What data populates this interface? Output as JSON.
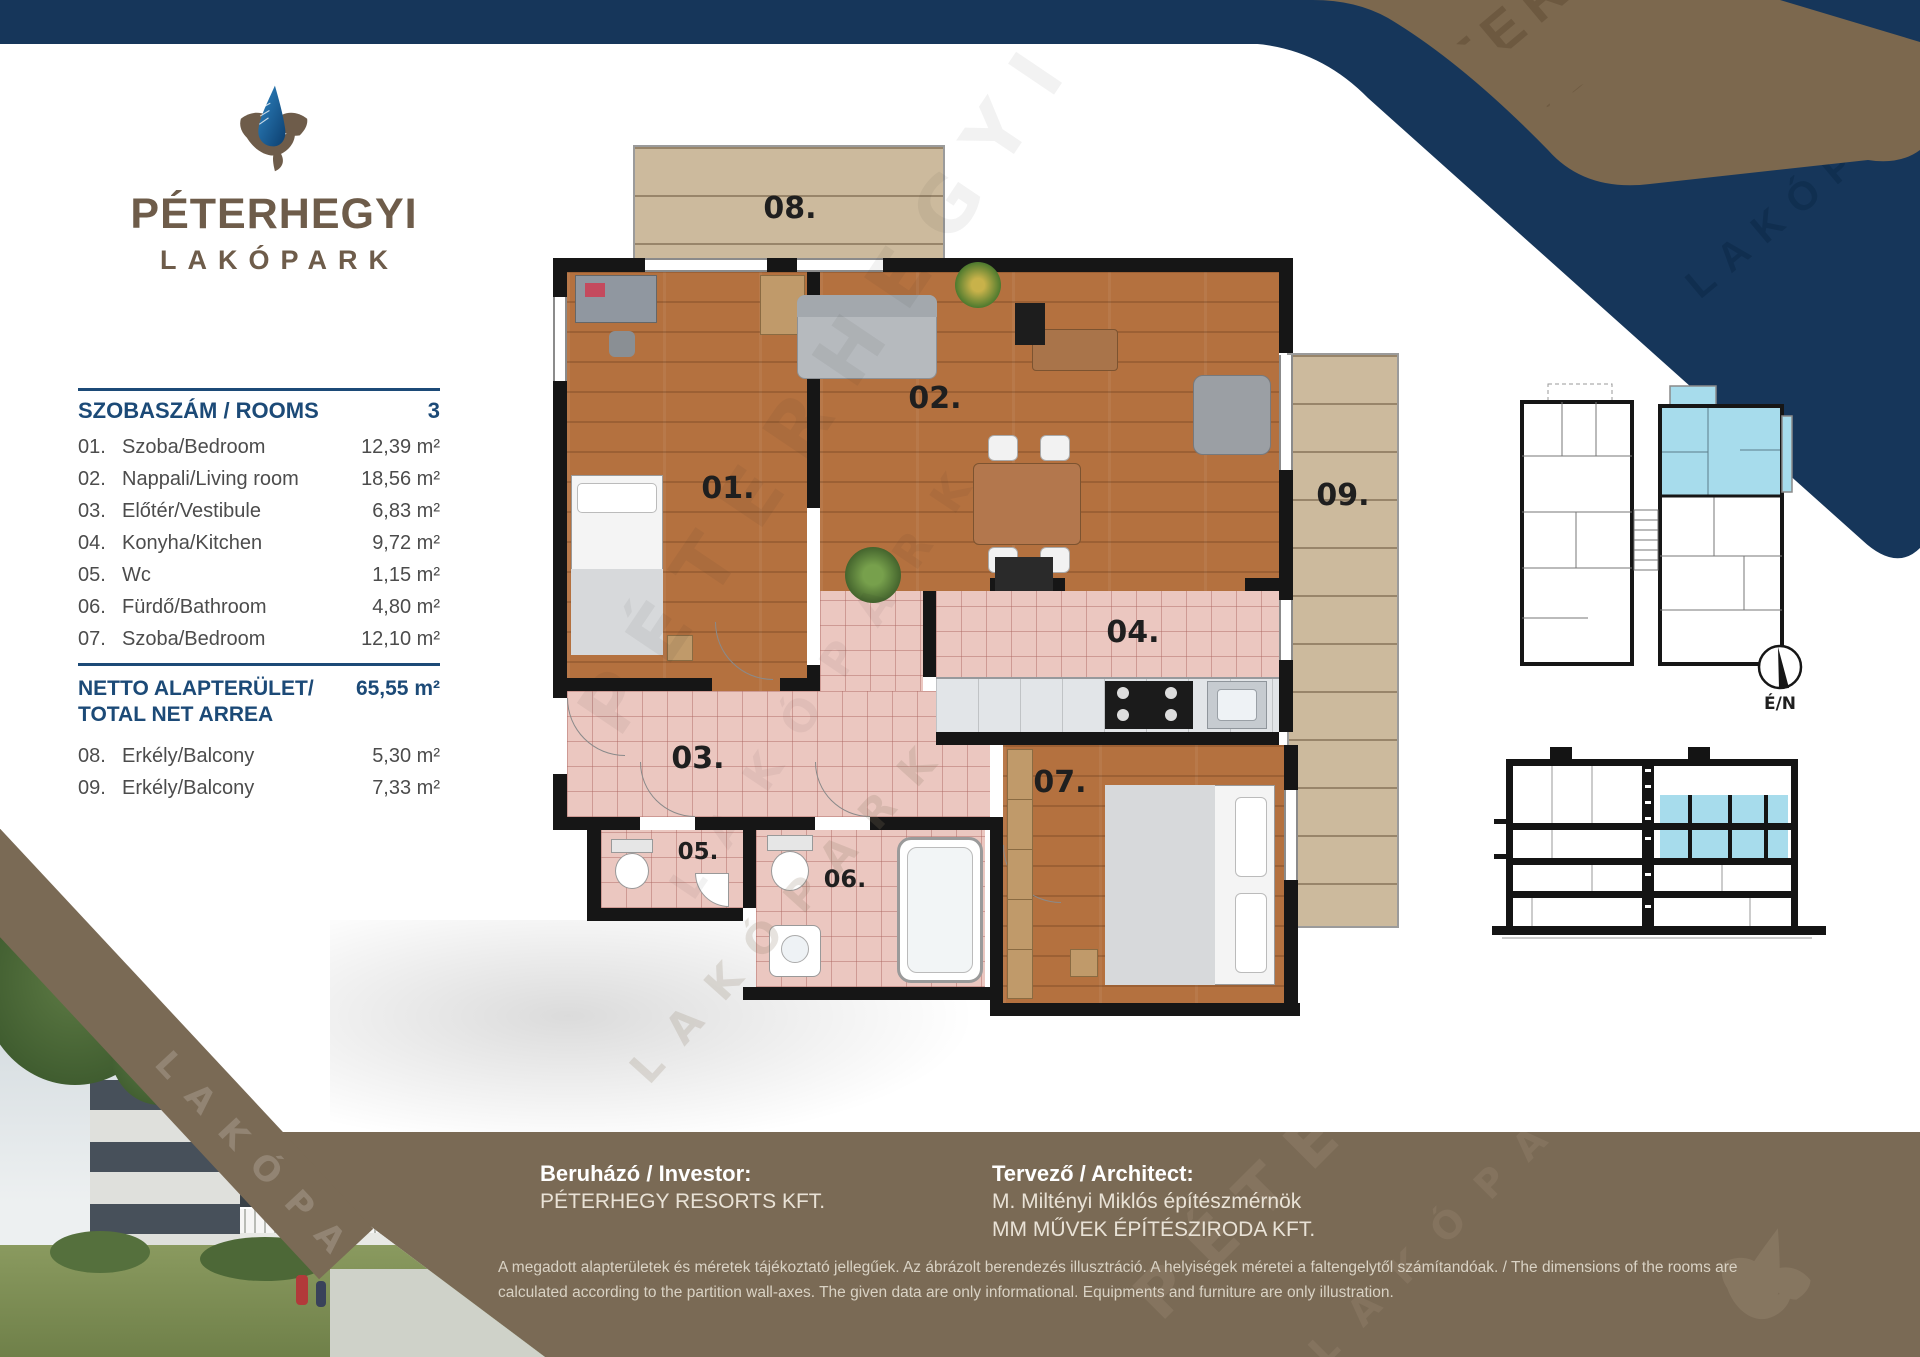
{
  "brand": {
    "line1": "PÉTERHEGYI",
    "line2": "LAKÓPARK"
  },
  "watermark": {
    "line1": "PÉTERHEGYI",
    "line2": "LAKÓPARK"
  },
  "table": {
    "header_label": "SZOBASZÁM / ROOMS",
    "header_value": "3",
    "rows": [
      {
        "num": "01.",
        "name": "Szoba/Bedroom",
        "area": "12,39 m²"
      },
      {
        "num": "02.",
        "name": "Nappali/Living room",
        "area": "18,56 m²"
      },
      {
        "num": "03.",
        "name": "Előtér/Vestibule",
        "area": "6,83 m²"
      },
      {
        "num": "04.",
        "name": "Konyha/Kitchen",
        "area": "9,72 m²"
      },
      {
        "num": "05.",
        "name": "Wc",
        "area": "1,15 m²"
      },
      {
        "num": "06.",
        "name": "Fürdő/Bathroom",
        "area": "4,80 m²"
      },
      {
        "num": "07.",
        "name": "Szoba/Bedroom",
        "area": "12,10 m²"
      }
    ],
    "total_label_line1": "NETTO ALAPTERÜLET/",
    "total_label_line2": "TOTAL NET ARREA",
    "total_value": "65,55 m²",
    "balcony_rows": [
      {
        "num": "08.",
        "name": "Erkély/Balcony",
        "area": "5,30 m²"
      },
      {
        "num": "09.",
        "name": "Erkély/Balcony",
        "area": "7,33 m²"
      }
    ]
  },
  "floorplan": {
    "labels": [
      "01.",
      "02.",
      "03.",
      "04.",
      "05.",
      "06.",
      "07.",
      "08.",
      "09."
    ]
  },
  "compass": {
    "label": "É/N"
  },
  "footer": {
    "investor_title": "Beruházó / Investor:",
    "investor_name": "PÉTERHEGY RESORTS KFT.",
    "architect_title": "Tervező / Architect:",
    "architect_line1": "M. Miltényi Miklós építészmérnök",
    "architect_line2": "MM MŰVEK ÉPÍTÉSZIRODA KFT.",
    "disclaimer": "A megadott alapterületek és méretek tájékoztató jellegűek. Az ábrázolt berendezés illusztráció. A helyiségek méretei a faltengelytől számítandóak. / The dimensions of the rooms are calculated according to the partition wall-axes. The given data are only informational. Equipments and furniture are only illustration."
  },
  "colors": {
    "navy": "#16365a",
    "brown": "#7a6a55",
    "accent_blue": "#1c4a77",
    "highlight_blue": "#a7dcec",
    "wood": "#b4713f",
    "tile": "#ebc7c0",
    "deck": "#ccba9d"
  }
}
